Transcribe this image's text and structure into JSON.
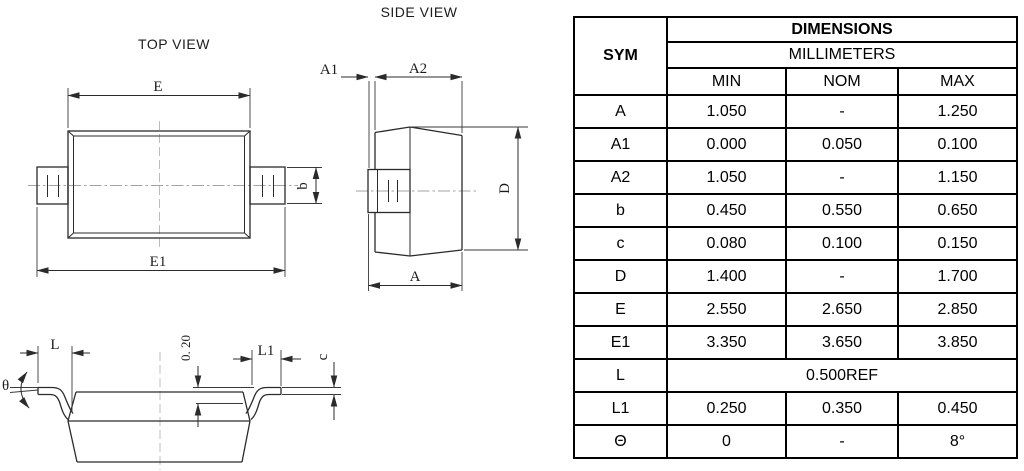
{
  "views": {
    "top": {
      "title": "TOP VIEW",
      "dim_e": "E",
      "dim_e1": "E1",
      "dim_b": "b"
    },
    "side": {
      "title": "SIDE VIEW",
      "dim_a1": "A1",
      "dim_a2": "A2",
      "dim_a": "A",
      "dim_d": "D"
    },
    "front": {
      "dim_theta": "θ",
      "dim_l": "L",
      "dim_standoff": "0. 20",
      "dim_l1": "L1",
      "dim_c": "c"
    }
  },
  "table": {
    "title": "DIMENSIONS",
    "units": "MILLIMETERS",
    "sym": "SYM",
    "cols": [
      "MIN",
      "NOM",
      "MAX"
    ],
    "rows": [
      {
        "sym": "A",
        "min": "1.050",
        "nom": "-",
        "max": "1.250"
      },
      {
        "sym": "A1",
        "min": "0.000",
        "nom": "0.050",
        "max": "0.100"
      },
      {
        "sym": "A2",
        "min": "1.050",
        "nom": "-",
        "max": "1.150"
      },
      {
        "sym": "b",
        "min": "0.450",
        "nom": "0.550",
        "max": "0.650"
      },
      {
        "sym": "c",
        "min": "0.080",
        "nom": "0.100",
        "max": "0.150"
      },
      {
        "sym": "D",
        "min": "1.400",
        "nom": "-",
        "max": "1.700"
      },
      {
        "sym": "E",
        "min": "2.550",
        "nom": "2.650",
        "max": "2.850"
      },
      {
        "sym": "E1",
        "min": "3.350",
        "nom": "3.650",
        "max": "3.850"
      },
      {
        "sym": "L",
        "value": "0.500REF"
      },
      {
        "sym": "L1",
        "min": "0.250",
        "nom": "0.350",
        "max": "0.450"
      },
      {
        "sym": "Θ",
        "min": "0",
        "nom": "-",
        "max": "8°"
      }
    ]
  },
  "colors": {
    "line": "#2b2b2b",
    "centerline": "#a3a3a3",
    "table_border": "#000000"
  }
}
